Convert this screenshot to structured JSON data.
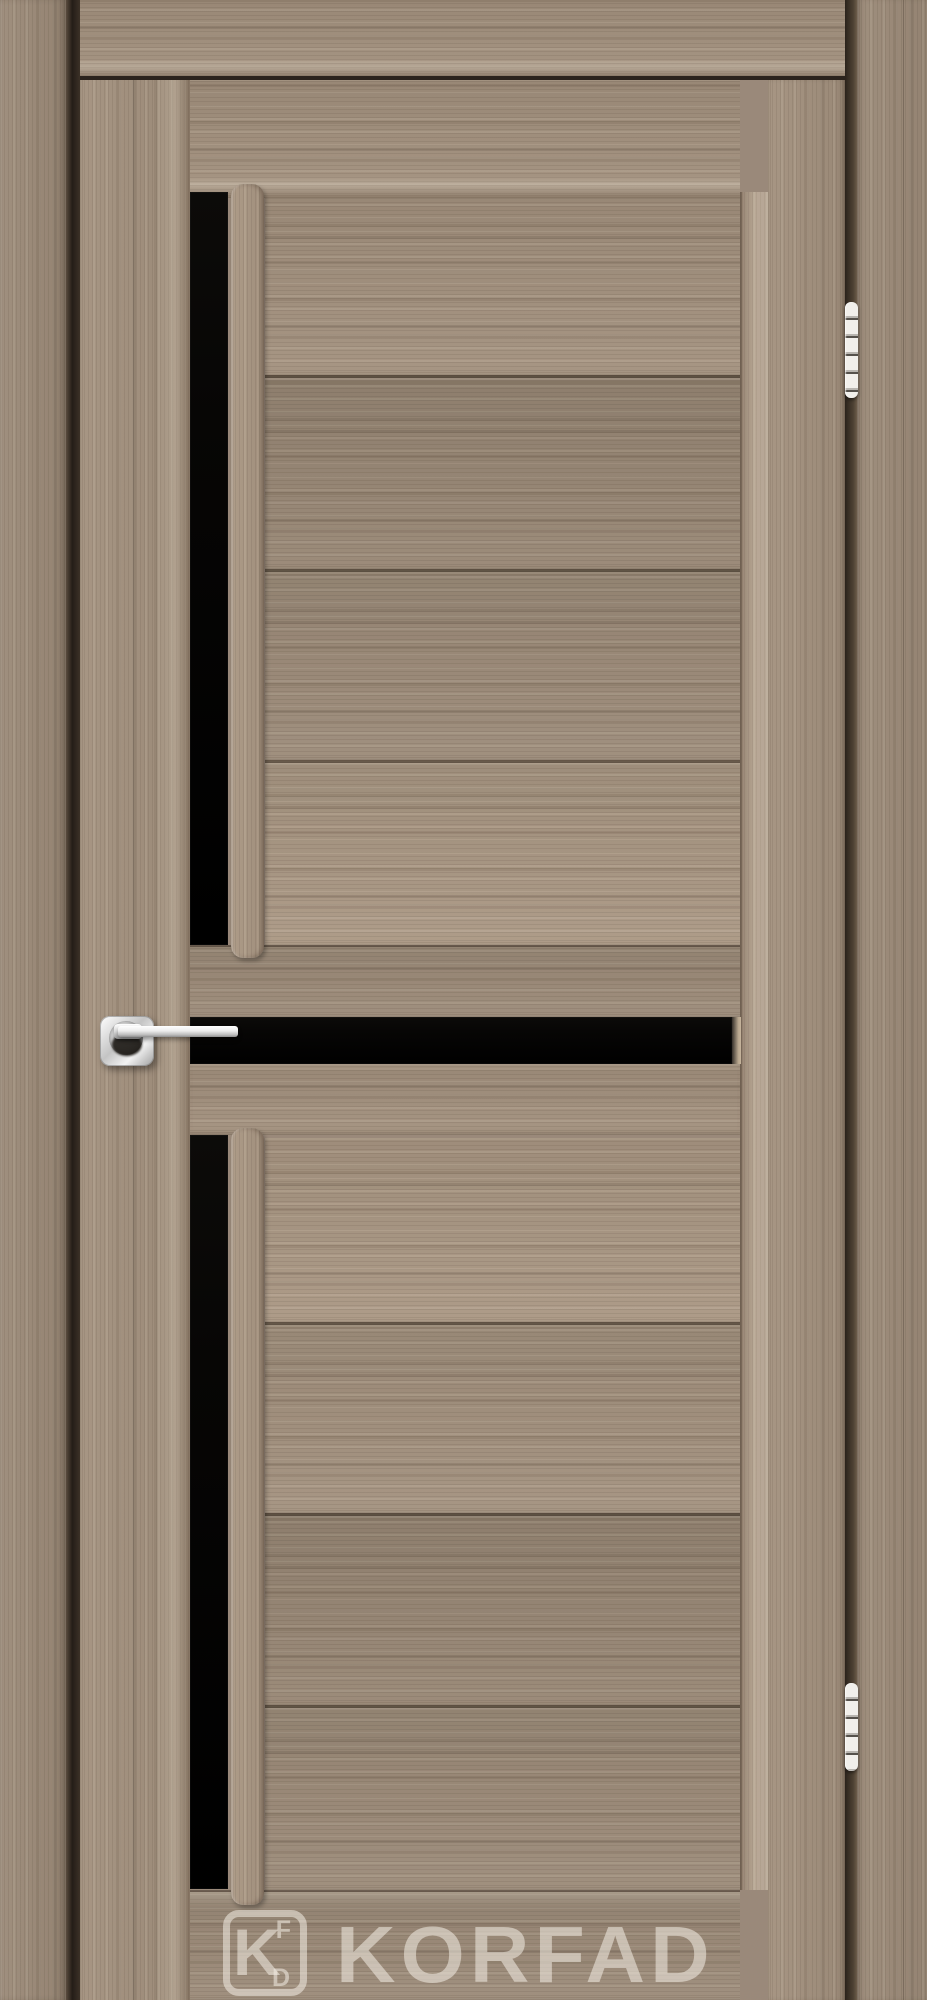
{
  "scene": {
    "subject": "interior wooden door with black glass inserts, closed in its frame"
  },
  "watermark": {
    "brand_text": "KORFAD",
    "monogram_main": "K",
    "monogram_top": "F",
    "monogram_bottom": "D"
  },
  "colors": {
    "wood-mid": "#a2907d",
    "wood-frame": "#9a897a",
    "glass": "#070605",
    "watermark": "rgba(244,239,230,0.55)"
  },
  "hardware": {
    "hinge_count": 2,
    "handle": "chrome lever on square rosette"
  }
}
